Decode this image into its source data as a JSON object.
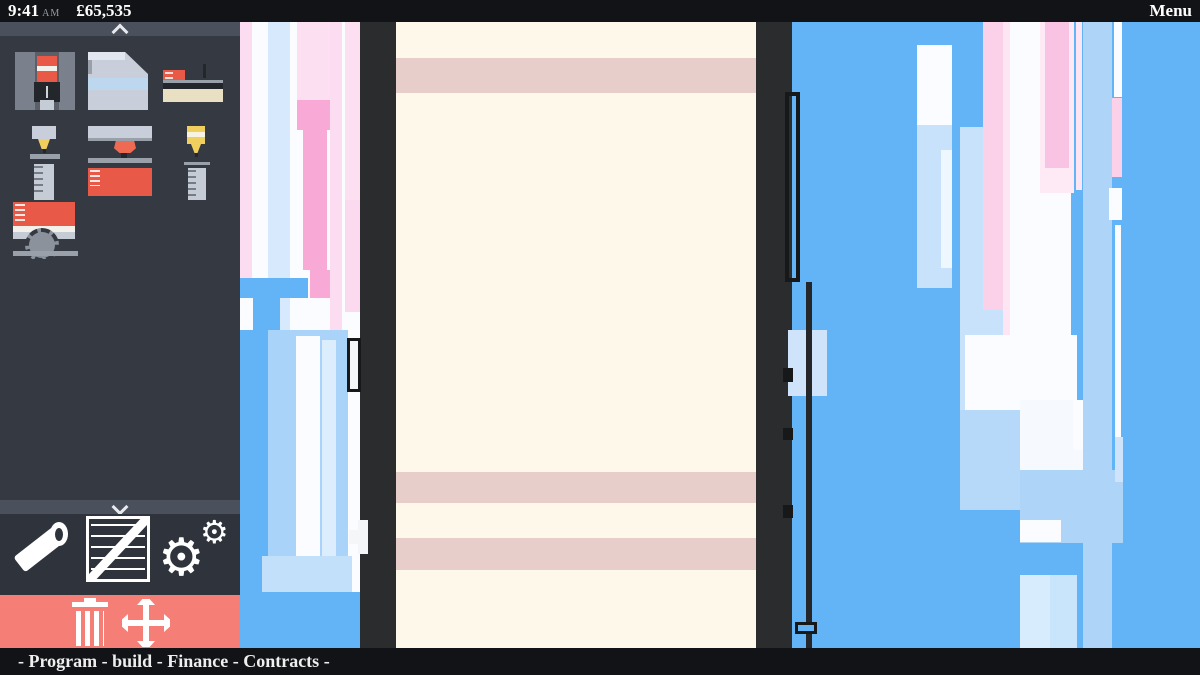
{
  "topbar": {
    "time": "9:41",
    "meridiem": "AM",
    "balance": "£65,535",
    "menu_label": "Menu"
  },
  "bottombar": {
    "items": [
      "Program",
      "build",
      "Finance",
      "Contracts"
    ],
    "separator": "-"
  },
  "sidebar": {
    "machines": [
      {
        "name": "vertical-mill-machine"
      },
      {
        "name": "metal-hopper-block"
      },
      {
        "name": "lathe-machine"
      },
      {
        "name": "small-drill-and-canister"
      },
      {
        "name": "wide-press-machine"
      },
      {
        "name": "injector-and-canister"
      },
      {
        "name": "circular-saw-machine"
      }
    ],
    "tools": [
      {
        "name": "pipe-tool"
      },
      {
        "name": "crate-tool"
      },
      {
        "name": "settings-gears"
      }
    ],
    "actions": [
      {
        "name": "demolish-trash"
      },
      {
        "name": "move-arrows"
      }
    ]
  },
  "colors": {
    "topbar_bg": "#121316",
    "sidebar_bg": "#343942",
    "toolbar_bg": "#2f343c",
    "chevron_bar_bg": "#4b515c",
    "action_bar_red": "#f57f77",
    "wall_dark": "#2b2c2e",
    "interior_cream": "#fdf8e9",
    "floor_stripe_pink": "#e8cecb",
    "sky_blue": "#63b4f6",
    "light_blue": "#a9d3f8",
    "pale_blue": "#cfe4fb",
    "pink": "#f8a9d6",
    "pale_pink": "#fbd9ee",
    "icon_red": "#e85948",
    "icon_yellow": "#f0cf5e"
  },
  "scene": {
    "rects": [
      {
        "n": "left-block-base",
        "x": 240,
        "y": 22,
        "w": 122,
        "h": 630,
        "c": "#fbfcff"
      },
      {
        "n": "left-stripe-pink-edge",
        "x": 240,
        "y": 22,
        "w": 12,
        "h": 268,
        "c": "#fbdcf0"
      },
      {
        "n": "left-stripe-lightblue",
        "x": 268,
        "y": 22,
        "w": 22,
        "h": 540,
        "c": "#d7e9fc"
      },
      {
        "n": "left-stripe-palepink-top",
        "x": 297,
        "y": 22,
        "w": 33,
        "h": 78,
        "c": "#fcdff1"
      },
      {
        "n": "left-block-pink",
        "x": 297,
        "y": 100,
        "w": 33,
        "h": 30,
        "c": "#f8a9d6"
      },
      {
        "n": "left-col-pink",
        "x": 303,
        "y": 130,
        "w": 24,
        "h": 140,
        "c": "#f8a9d6"
      },
      {
        "n": "left-block-pink-2",
        "x": 310,
        "y": 270,
        "w": 20,
        "h": 28,
        "c": "#f8a9d6"
      },
      {
        "n": "left-stripe-palepink",
        "x": 330,
        "y": 22,
        "w": 12,
        "h": 556,
        "c": "#fbdcf0"
      },
      {
        "n": "left-stripe-palepink-right",
        "x": 345,
        "y": 22,
        "w": 15,
        "h": 288,
        "c": "#fcdff1"
      },
      {
        "n": "left-col-palepink-low",
        "x": 345,
        "y": 200,
        "w": 15,
        "h": 112,
        "c": "#fbd9ee"
      },
      {
        "n": "crane-arm",
        "x": 240,
        "y": 278,
        "w": 68,
        "h": 20,
        "c": "#63b4f6"
      },
      {
        "n": "crane-stem",
        "x": 253,
        "y": 298,
        "w": 27,
        "h": 96,
        "c": "#63b4f6"
      },
      {
        "n": "left-blue-col",
        "x": 240,
        "y": 330,
        "w": 28,
        "h": 322,
        "c": "#63b4f6"
      },
      {
        "n": "left-lightblue-region",
        "x": 268,
        "y": 330,
        "w": 80,
        "h": 322,
        "c": "#a9d3f8"
      },
      {
        "n": "left-white-col",
        "x": 296,
        "y": 336,
        "w": 24,
        "h": 286,
        "c": "#fbfcff"
      },
      {
        "n": "left-pale-col",
        "x": 322,
        "y": 340,
        "w": 14,
        "h": 268,
        "c": "#dceefd"
      },
      {
        "n": "left-paleblue-patch",
        "x": 262,
        "y": 556,
        "w": 90,
        "h": 44,
        "c": "#c3e0fa"
      },
      {
        "n": "left-blue-bottom",
        "x": 240,
        "y": 592,
        "w": 120,
        "h": 60,
        "c": "#63b4f6"
      },
      {
        "n": "left-wall",
        "x": 360,
        "y": 22,
        "w": 36,
        "h": 630,
        "c": "#2b2c2e"
      },
      {
        "n": "wall-door",
        "x": 347,
        "y": 338,
        "w": 14,
        "h": 54,
        "c": "#f4f6f8",
        "b": "3px solid #17181a"
      },
      {
        "n": "wall-handle-v",
        "x": 358,
        "y": 520,
        "w": 10,
        "h": 34,
        "c": "#f4f6f8"
      },
      {
        "n": "wall-handle-h",
        "x": 349,
        "y": 530,
        "w": 10,
        "h": 14,
        "c": "#f4f6f8"
      },
      {
        "n": "building-interior",
        "x": 396,
        "y": 22,
        "w": 360,
        "h": 630,
        "c": "#fdf8e9"
      },
      {
        "n": "floor-stripe-1",
        "x": 396,
        "y": 58,
        "w": 360,
        "h": 35,
        "c": "#e8cecb"
      },
      {
        "n": "floor-stripe-2",
        "x": 396,
        "y": 472,
        "w": 360,
        "h": 31,
        "c": "#e8cecb"
      },
      {
        "n": "floor-stripe-3",
        "x": 396,
        "y": 538,
        "w": 360,
        "h": 32,
        "c": "#e8cecb"
      },
      {
        "n": "right-wall",
        "x": 756,
        "y": 22,
        "w": 36,
        "h": 630,
        "c": "#2b2c2e"
      },
      {
        "n": "sky-base",
        "x": 792,
        "y": 22,
        "w": 408,
        "h": 630,
        "c": "#63b4f6"
      },
      {
        "n": "wall-lightblue-col",
        "x": 788,
        "y": 330,
        "w": 39,
        "h": 66,
        "c": "#cfe4fb"
      },
      {
        "n": "wall-bracket",
        "x": 785,
        "y": 92,
        "w": 15,
        "h": 190,
        "c": "transparent",
        "b": "4px solid #17181a"
      },
      {
        "n": "wall-pole",
        "x": 806,
        "y": 282,
        "w": 6,
        "h": 370,
        "c": "#24262a"
      },
      {
        "n": "pole-nub-1",
        "x": 783,
        "y": 368,
        "w": 10,
        "h": 14,
        "c": "#17181a"
      },
      {
        "n": "pole-nub-2",
        "x": 783,
        "y": 428,
        "w": 10,
        "h": 12,
        "c": "#17181a"
      },
      {
        "n": "pole-nub-3",
        "x": 783,
        "y": 505,
        "w": 10,
        "h": 13,
        "c": "#17181a"
      },
      {
        "n": "pole-crate",
        "x": 795,
        "y": 622,
        "w": 22,
        "h": 12,
        "c": "#63b4f6",
        "b": "3px solid #17181a"
      },
      {
        "n": "tower-white-top",
        "x": 917,
        "y": 45,
        "w": 35,
        "h": 80,
        "c": "#fafcff"
      },
      {
        "n": "tower-paleblue",
        "x": 917,
        "y": 125,
        "w": 35,
        "h": 163,
        "c": "#c9e2fb"
      },
      {
        "n": "tower-inner-light",
        "x": 941,
        "y": 150,
        "w": 11,
        "h": 118,
        "c": "#eef6fe"
      },
      {
        "n": "col-paleblue",
        "x": 960,
        "y": 127,
        "w": 43,
        "h": 290,
        "c": "#c9e2fb"
      },
      {
        "n": "col-pink",
        "x": 983,
        "y": 22,
        "w": 26,
        "h": 288,
        "c": "#fbd0e9"
      },
      {
        "n": "col-palepink-thin",
        "x": 1003,
        "y": 22,
        "w": 7,
        "h": 450,
        "c": "#fde5f3"
      },
      {
        "n": "tower-white-big",
        "x": 1010,
        "y": 22,
        "w": 61,
        "h": 380,
        "c": "#fafcff"
      },
      {
        "n": "pink-wrap",
        "x": 1040,
        "y": 22,
        "w": 34,
        "h": 171,
        "c": "#fdeaf5"
      },
      {
        "n": "pink-strip",
        "x": 1045,
        "y": 22,
        "w": 24,
        "h": 146,
        "c": "#f9c4e3"
      },
      {
        "n": "palepink-thin-2",
        "x": 1076,
        "y": 22,
        "w": 6,
        "h": 168,
        "c": "#fde5f3"
      },
      {
        "n": "col-lightblue-tall",
        "x": 1083,
        "y": 22,
        "w": 29,
        "h": 630,
        "c": "#aed5f8"
      },
      {
        "n": "thin-white-top",
        "x": 1114,
        "y": 22,
        "w": 8,
        "h": 75,
        "c": "#fafcff"
      },
      {
        "n": "pink-seg",
        "x": 1112,
        "y": 98,
        "w": 10,
        "h": 79,
        "c": "#fbd0e9"
      },
      {
        "n": "white-block-sm",
        "x": 1109,
        "y": 188,
        "w": 13,
        "h": 32,
        "c": "#fafcff"
      },
      {
        "n": "thin-white-line",
        "x": 1115,
        "y": 225,
        "w": 6,
        "h": 255,
        "c": "#fafcff"
      },
      {
        "n": "cluster-white-band",
        "x": 965,
        "y": 335,
        "w": 112,
        "h": 75,
        "c": "#fafcff"
      },
      {
        "n": "cluster-white-right",
        "x": 1020,
        "y": 400,
        "w": 63,
        "h": 70,
        "c": "#f6fafe"
      },
      {
        "n": "cluster-step-left",
        "x": 960,
        "y": 410,
        "w": 60,
        "h": 100,
        "c": "#b7d9f9"
      },
      {
        "n": "cluster-lightblue-wide",
        "x": 1020,
        "y": 470,
        "w": 103,
        "h": 73,
        "c": "#aed5f8"
      },
      {
        "n": "cluster-white-block",
        "x": 1020,
        "y": 520,
        "w": 41,
        "h": 22,
        "c": "#fafcff"
      },
      {
        "n": "thin-white-2",
        "x": 1073,
        "y": 400,
        "w": 10,
        "h": 50,
        "c": "#fafcff"
      },
      {
        "n": "paleblue-thin",
        "x": 1115,
        "y": 437,
        "w": 8,
        "h": 45,
        "c": "#cfe4fb"
      },
      {
        "n": "bottom-col",
        "x": 1020,
        "y": 575,
        "w": 57,
        "h": 77,
        "c": "#d7ecfd"
      },
      {
        "n": "bottom-col-inner",
        "x": 1050,
        "y": 575,
        "w": 27,
        "h": 77,
        "c": "#c9e5fc"
      }
    ]
  }
}
